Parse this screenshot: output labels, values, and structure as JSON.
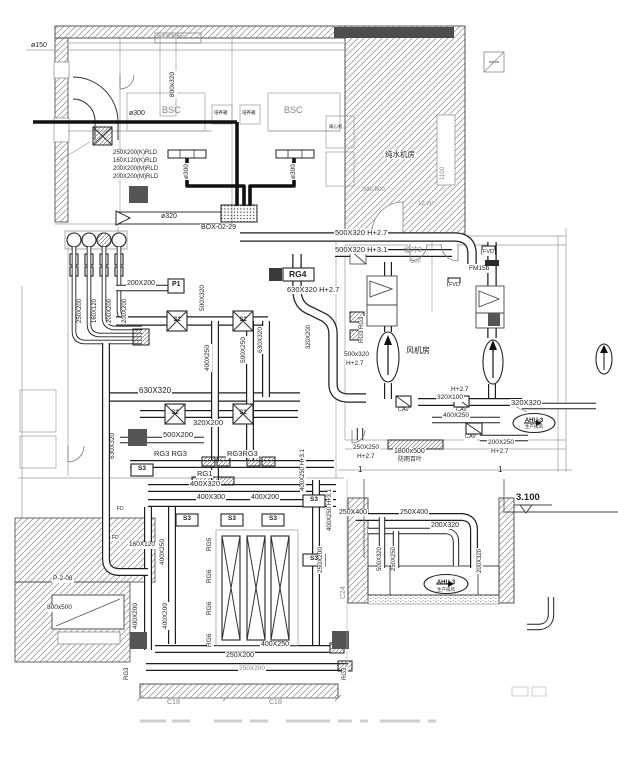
{
  "palette": {
    "ink": "#1f1f1f",
    "gray": "#858585",
    "dark": "#555555"
  },
  "annotations": [
    {
      "n": "duct-dia-label",
      "t": "ø150",
      "x": 31,
      "y": 42,
      "s": 7
    },
    {
      "n": "roof-note-label",
      "t": "接至屋面用PG",
      "x": 157,
      "y": 35,
      "s": 4.5,
      "c": "gray"
    },
    {
      "n": "duct-size-label",
      "t": "800x320",
      "x": 170,
      "y": 98,
      "r": -90,
      "s": 6.5,
      "b": 1
    },
    {
      "n": "room-label-pure-water",
      "t": "纯水机房",
      "x": 384,
      "y": 151,
      "s": 7.5,
      "b": 1
    },
    {
      "n": "dim-label",
      "t": "580 800",
      "x": 363,
      "y": 187,
      "s": 6,
      "c": "gray"
    },
    {
      "n": "dim-label",
      "t": "1100",
      "x": 440,
      "y": 180,
      "r": -90,
      "s": 6,
      "c": "gray"
    },
    {
      "n": "area-label",
      "t": "12 m²",
      "x": 418,
      "y": 201,
      "s": 6,
      "c": "gray"
    },
    {
      "n": "equip-label-bsc",
      "t": "BSC",
      "x": 162,
      "y": 106,
      "s": 9,
      "c": "gray"
    },
    {
      "n": "equip-label-bsc",
      "t": "BSC",
      "x": 284,
      "y": 106,
      "s": 9,
      "c": "gray"
    },
    {
      "n": "equip-label",
      "t": "培养箱",
      "x": 214,
      "y": 111,
      "s": 4.5
    },
    {
      "n": "equip-label",
      "t": "培养箱",
      "x": 242,
      "y": 111,
      "s": 4.5
    },
    {
      "n": "equip-label",
      "t": "离心机",
      "x": 329,
      "y": 125,
      "s": 4.5
    },
    {
      "n": "pipe-dia-label",
      "t": "ø300",
      "x": 128,
      "y": 110,
      "s": 7,
      "b": 1
    },
    {
      "n": "pipe-dia-label",
      "t": "ø300",
      "x": 184,
      "y": 180,
      "r": -90,
      "s": 6.5,
      "b": 1
    },
    {
      "n": "pipe-dia-label",
      "t": "ø300",
      "x": 291,
      "y": 180,
      "r": -90,
      "s": 6.5,
      "b": 1
    },
    {
      "n": "riser-schedule-row",
      "t": "250X200(K)RLD",
      "x": 112,
      "y": 150,
      "s": 6,
      "b": 1
    },
    {
      "n": "riser-schedule-row",
      "t": "160X120(K)RLD",
      "x": 112,
      "y": 158,
      "s": 6,
      "b": 1
    },
    {
      "n": "riser-schedule-row",
      "t": "200X200(M)RLD",
      "x": 112,
      "y": 166,
      "s": 6,
      "b": 1
    },
    {
      "n": "riser-schedule-row",
      "t": "200X200(M)RLD",
      "x": 112,
      "y": 174,
      "s": 6,
      "b": 1
    },
    {
      "n": "duct-dia-label",
      "t": "ø320",
      "x": 160,
      "y": 213,
      "s": 7,
      "b": 1
    },
    {
      "n": "box-tag-label",
      "t": "BOX-02-29",
      "x": 200,
      "y": 224,
      "s": 7,
      "b": 1
    },
    {
      "n": "duct-size-label",
      "t": "500X320 H+2.7",
      "x": 334,
      "y": 229,
      "s": 7.5,
      "b": 1
    },
    {
      "n": "duct-size-label",
      "t": "500X320 H+3.1",
      "x": 334,
      "y": 246,
      "s": 7.5,
      "b": 1
    },
    {
      "n": "room-label-buffer",
      "t": "缓冲2",
      "x": 404,
      "y": 247,
      "s": 7,
      "c": "gray"
    },
    {
      "n": "area-label",
      "t": "5m²",
      "x": 411,
      "y": 259,
      "s": 6,
      "c": "gray"
    },
    {
      "n": "device-label-fvd",
      "t": "FVD",
      "x": 482,
      "y": 250,
      "s": 5.5,
      "b": 1
    },
    {
      "n": "device-label-fm",
      "t": "FM15b",
      "x": 468,
      "y": 266,
      "s": 6.5,
      "b": 1
    },
    {
      "n": "device-label-fvd",
      "t": "FVD",
      "x": 448,
      "y": 283,
      "s": 5.5,
      "b": 1
    },
    {
      "n": "grille-label",
      "t": "RG4",
      "x": 288,
      "y": 270,
      "s": 8.5,
      "w": 1,
      "b": 1
    },
    {
      "n": "duct-size-label",
      "t": "630X320 H+2.7",
      "x": 286,
      "y": 286,
      "s": 7.5,
      "b": 1
    },
    {
      "n": "room-label-fan",
      "t": "风机房",
      "x": 406,
      "y": 347,
      "s": 8
    },
    {
      "n": "duct-size-label",
      "t": "500x320",
      "x": 343,
      "y": 352,
      "s": 6.5,
      "b": 1
    },
    {
      "n": "height-label",
      "t": "H+2.7",
      "x": 345,
      "y": 361,
      "s": 6.5,
      "b": 1
    },
    {
      "n": "duct-size-label",
      "t": "630X320",
      "x": 258,
      "y": 354,
      "r": -90,
      "s": 6.5,
      "b": 1
    },
    {
      "n": "duct-size-label",
      "t": "320X200",
      "x": 306,
      "y": 350,
      "r": -90,
      "s": 6,
      "b": 1
    },
    {
      "n": "grille-label",
      "t": "RG3 RG3",
      "x": 359,
      "y": 344,
      "r": -90,
      "s": 6,
      "b": 1
    },
    {
      "n": "duct-size-label",
      "t": "400X250",
      "x": 205,
      "y": 372,
      "r": -90,
      "s": 6.5,
      "b": 1
    },
    {
      "n": "duct-size-label",
      "t": "500X250",
      "x": 241,
      "y": 364,
      "r": -90,
      "s": 6.5,
      "b": 1
    },
    {
      "n": "duct-size-label",
      "t": "630X320",
      "x": 138,
      "y": 387,
      "s": 8,
      "b": 1
    },
    {
      "n": "duct-size-label",
      "t": "320X200",
      "x": 192,
      "y": 419,
      "s": 7.5,
      "b": 1
    },
    {
      "n": "duct-size-label",
      "t": "500X200",
      "x": 162,
      "y": 431,
      "s": 7.5,
      "b": 1
    },
    {
      "n": "grille-label",
      "t": "RG3 RG3",
      "x": 153,
      "y": 450,
      "s": 7.5,
      "b": 1
    },
    {
      "n": "grille-label",
      "t": "RG3RG3",
      "x": 226,
      "y": 450,
      "s": 7.5,
      "b": 1
    },
    {
      "n": "grille-label",
      "t": "RG1",
      "x": 196,
      "y": 470,
      "s": 7.5,
      "b": 1
    },
    {
      "n": "duct-size-label",
      "t": "400X320",
      "x": 189,
      "y": 480,
      "s": 7.5,
      "b": 1
    },
    {
      "n": "duct-size-label",
      "t": "400X300",
      "x": 196,
      "y": 494,
      "s": 7,
      "b": 1
    },
    {
      "n": "duct-size-label",
      "t": "400X200",
      "x": 250,
      "y": 494,
      "s": 7,
      "b": 1
    },
    {
      "n": "duct-size-label",
      "t": "630X320",
      "x": 110,
      "y": 460,
      "r": -90,
      "s": 6.5,
      "b": 1
    },
    {
      "n": "duct-size-label",
      "t": "160X120",
      "x": 128,
      "y": 542,
      "s": 6.5,
      "b": 1
    },
    {
      "n": "duct-size-label",
      "t": "400X250",
      "x": 160,
      "y": 566,
      "r": -90,
      "s": 6.5,
      "b": 1
    },
    {
      "n": "duct-size-label",
      "t": "400X200",
      "x": 133,
      "y": 630,
      "r": -90,
      "s": 6.5,
      "b": 1
    },
    {
      "n": "duct-size-label",
      "t": "400X200",
      "x": 163,
      "y": 630,
      "r": -90,
      "s": 6.5,
      "b": 1
    },
    {
      "n": "duct-size-label",
      "t": "400X250 H+3.1",
      "x": 300,
      "y": 492,
      "r": -90,
      "s": 6,
      "b": 1
    },
    {
      "n": "duct-size-label",
      "t": "400X250 H+3.1",
      "x": 327,
      "y": 532,
      "r": -90,
      "s": 6,
      "b": 1
    },
    {
      "n": "duct-size-label",
      "t": "250X200",
      "x": 318,
      "y": 574,
      "r": -90,
      "s": 6.5,
      "b": 1
    },
    {
      "n": "grille-label",
      "t": "RG5",
      "x": 207,
      "y": 552,
      "r": -90,
      "s": 6.5,
      "b": 1
    },
    {
      "n": "grille-label",
      "t": "RG6",
      "x": 207,
      "y": 584,
      "r": -90,
      "s": 6.5,
      "b": 1
    },
    {
      "n": "grille-label",
      "t": "RG6",
      "x": 207,
      "y": 616,
      "r": -90,
      "s": 6.5,
      "b": 1
    },
    {
      "n": "grille-label",
      "t": "RG6",
      "x": 207,
      "y": 648,
      "r": -90,
      "s": 6.5,
      "b": 1
    },
    {
      "n": "duct-size-label",
      "t": "400X250",
      "x": 260,
      "y": 641,
      "s": 7,
      "b": 1
    },
    {
      "n": "duct-size-label",
      "t": "250X200",
      "x": 225,
      "y": 652,
      "s": 7,
      "b": 1
    },
    {
      "n": "duct-size-label",
      "t": "250X200",
      "x": 238,
      "y": 666,
      "s": 6.5,
      "c": "gray",
      "b": 1
    },
    {
      "n": "grid-label",
      "t": "C18",
      "x": 166,
      "y": 699,
      "s": 7,
      "c": "gray",
      "b": 1
    },
    {
      "n": "grid-label",
      "t": "C18",
      "x": 268,
      "y": 699,
      "s": 7,
      "c": "gray",
      "b": 1
    },
    {
      "n": "grille-label",
      "t": "RG3",
      "x": 124,
      "y": 681,
      "r": -90,
      "s": 6,
      "b": 1
    },
    {
      "n": "grille-label",
      "t": "RG3",
      "x": 342,
      "y": 681,
      "r": -90,
      "s": 6,
      "b": 1
    },
    {
      "n": "grid-label",
      "t": "C24",
      "x": 340,
      "y": 600,
      "r": -90,
      "s": 7,
      "c": "gray",
      "b": 1
    },
    {
      "n": "height-label",
      "t": "H+2.7",
      "x": 450,
      "y": 387,
      "s": 6.5,
      "b": 1
    },
    {
      "n": "duct-size-label",
      "t": "320X100",
      "x": 436,
      "y": 395,
      "s": 6.5,
      "b": 1
    },
    {
      "n": "device-label-cav",
      "t": "CAV",
      "x": 397,
      "y": 408,
      "s": 5.5,
      "b": 1
    },
    {
      "n": "device-label-cav",
      "t": "CAV",
      "x": 455,
      "y": 408,
      "s": 5.5,
      "b": 1
    },
    {
      "n": "device-label-cav",
      "t": "CAV",
      "x": 464,
      "y": 435,
      "s": 5.5,
      "b": 1
    },
    {
      "n": "duct-size-label",
      "t": "320X320",
      "x": 510,
      "y": 399,
      "s": 7.5,
      "b": 1
    },
    {
      "n": "equip-tag",
      "t": "AHU-3",
      "x": 534,
      "y": 418,
      "s": 6,
      "ctr": 1,
      "w": 1
    },
    {
      "n": "equip-tag-sub",
      "t": "生产排风",
      "x": 534,
      "y": 425,
      "s": 4.5,
      "ctr": 1
    },
    {
      "n": "duct-size-label",
      "t": "400X250",
      "x": 442,
      "y": 413,
      "s": 6.5,
      "b": 1
    },
    {
      "n": "duct-size-label",
      "t": "200X250",
      "x": 487,
      "y": 440,
      "s": 6.5,
      "b": 1
    },
    {
      "n": "height-label",
      "t": "H+2.7",
      "x": 490,
      "y": 449,
      "s": 6.5,
      "b": 1
    },
    {
      "n": "louver-size-label",
      "t": "1800x500",
      "x": 393,
      "y": 448,
      "s": 7,
      "b": 1
    },
    {
      "n": "louver-label",
      "t": "防雨百叶",
      "x": 398,
      "y": 457,
      "s": 6
    },
    {
      "n": "duct-size-label",
      "t": "250X250",
      "x": 352,
      "y": 445,
      "s": 6.5,
      "b": 1
    },
    {
      "n": "height-label",
      "t": "H+2.7",
      "x": 356,
      "y": 454,
      "s": 6.5,
      "b": 1
    },
    {
      "n": "elevation-label",
      "t": "3.100",
      "x": 516,
      "y": 493,
      "s": 9.5,
      "w": 1
    },
    {
      "n": "section-mark-label",
      "t": "1",
      "x": 358,
      "y": 466,
      "s": 8
    },
    {
      "n": "section-mark-label",
      "t": "1",
      "x": 498,
      "y": 466,
      "s": 8
    },
    {
      "n": "duct-size-label",
      "t": "250X400",
      "x": 338,
      "y": 509,
      "s": 7,
      "b": 1
    },
    {
      "n": "duct-size-label",
      "t": "250X400",
      "x": 399,
      "y": 509,
      "s": 7,
      "b": 1
    },
    {
      "n": "duct-size-label",
      "t": "200X320",
      "x": 430,
      "y": 522,
      "s": 7,
      "b": 1
    },
    {
      "n": "duct-size-label",
      "t": "500X320",
      "x": 377,
      "y": 572,
      "r": -90,
      "s": 6,
      "b": 1
    },
    {
      "n": "duct-size-label",
      "t": "250X250",
      "x": 391,
      "y": 572,
      "r": -90,
      "s": 6,
      "b": 1
    },
    {
      "n": "duct-size-label",
      "t": "200X320",
      "x": 477,
      "y": 574,
      "r": -90,
      "s": 6,
      "b": 1
    },
    {
      "n": "equip-tag",
      "t": "AHU-3",
      "x": 446,
      "y": 580,
      "s": 6,
      "ctr": 1,
      "w": 1
    },
    {
      "n": "equip-tag-sub",
      "t": "生产排风",
      "x": 446,
      "y": 588,
      "s": 4.5,
      "ctr": 1
    },
    {
      "n": "fan-tag",
      "t": "P-2-08",
      "x": 52,
      "y": 576,
      "s": 6.5,
      "b": 1
    },
    {
      "n": "louver-size-label",
      "t": "800x500",
      "x": 46,
      "y": 605,
      "s": 6.5,
      "b": 1
    },
    {
      "n": "device-label-fd",
      "t": "FD",
      "x": 116,
      "y": 507,
      "s": 5,
      "b": 1
    },
    {
      "n": "device-label-fd",
      "t": "FD",
      "x": 111,
      "y": 536,
      "s": 5,
      "b": 1
    },
    {
      "n": "pump-tag",
      "t": "P1",
      "x": 172,
      "y": 281,
      "s": 7,
      "w": 1
    },
    {
      "n": "duct-size-label",
      "t": "200X200",
      "x": 126,
      "y": 280,
      "s": 7,
      "b": 1
    },
    {
      "n": "duct-size-label",
      "t": "500X320",
      "x": 200,
      "y": 312,
      "r": -90,
      "s": 6.5,
      "b": 1
    },
    {
      "n": "riser-size-label",
      "t": "250X200",
      "x": 77,
      "y": 324,
      "r": -90,
      "s": 6,
      "b": 1
    },
    {
      "n": "riser-size-label",
      "t": "160X120",
      "x": 92,
      "y": 324,
      "r": -90,
      "s": 6,
      "b": 1
    },
    {
      "n": "riser-size-label",
      "t": "200X200",
      "x": 107,
      "y": 324,
      "r": -90,
      "s": 6,
      "b": 1
    },
    {
      "n": "riser-size-label",
      "t": "200X200",
      "x": 122,
      "y": 324,
      "r": -90,
      "s": 6,
      "b": 1
    },
    {
      "n": "diffuser-label",
      "t": "S2",
      "x": 177,
      "y": 317,
      "s": 6,
      "ctr": 1,
      "w": 1
    },
    {
      "n": "diffuser-label",
      "t": "S2",
      "x": 243,
      "y": 317,
      "s": 6,
      "ctr": 1,
      "w": 1
    },
    {
      "n": "diffuser-label",
      "t": "S2",
      "x": 175,
      "y": 410,
      "s": 6,
      "ctr": 1,
      "w": 1
    },
    {
      "n": "diffuser-label",
      "t": "S2",
      "x": 243,
      "y": 410,
      "s": 6,
      "ctr": 1,
      "w": 1
    },
    {
      "n": "diffuser-label",
      "t": "S3",
      "x": 142,
      "y": 466,
      "s": 6.5,
      "ctr": 1,
      "w": 1
    },
    {
      "n": "diffuser-label",
      "t": "S3",
      "x": 187,
      "y": 516,
      "s": 6.5,
      "ctr": 1,
      "w": 1
    },
    {
      "n": "diffuser-label",
      "t": "S3",
      "x": 232,
      "y": 516,
      "s": 6.5,
      "ctr": 1,
      "w": 1
    },
    {
      "n": "diffuser-label",
      "t": "S3",
      "x": 273,
      "y": 516,
      "s": 6.5,
      "ctr": 1,
      "w": 1
    },
    {
      "n": "diffuser-label",
      "t": "S3",
      "x": 314,
      "y": 497,
      "s": 6.5,
      "ctr": 1,
      "w": 1
    },
    {
      "n": "diffuser-label",
      "t": "S3",
      "x": 314,
      "y": 556,
      "s": 6.5,
      "ctr": 1,
      "w": 1
    }
  ]
}
